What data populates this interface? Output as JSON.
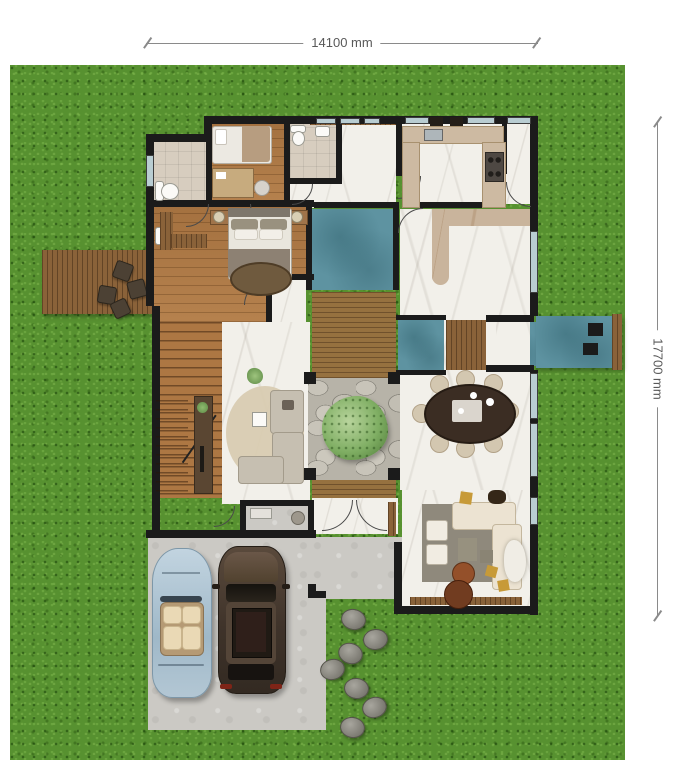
{
  "annotations": {
    "width_label": "14100 mm",
    "height_label": "17700 mm"
  },
  "palette": {
    "page_bg": "#ffffff",
    "grass": "#579130",
    "wall": "#1b1b1b",
    "marble": "#f2f0ea",
    "tile": "#d7cdbf",
    "wood_floor": "#ad7743",
    "deck_wood": "#8a6239",
    "walkway_wood": "#96713f",
    "water_teal": "#5e93a1",
    "stone": "#b7b3a8",
    "concrete": "#cbc9c4",
    "tree_green": "#7fae63",
    "window_glass": "#b9cdd2",
    "dim_line": "#8a8a8a",
    "dim_text": "#595959"
  },
  "scene": {
    "type": "residential-floor-plan-top-view",
    "rooms": [
      "bathroom",
      "small-bedroom",
      "second-bathroom",
      "entry-hall",
      "kitchen",
      "pantry",
      "master-bedroom",
      "staircase",
      "living-room",
      "courtyard-with-tree",
      "dining-room",
      "family-room",
      "wc",
      "vestibule"
    ],
    "exterior": [
      "lawn",
      "wood-deck",
      "driveway",
      "patio",
      "stepping-stones",
      "water-feature-walkway",
      "water-squares"
    ],
    "vehicles": [
      "convertible-car",
      "suv-car"
    ],
    "stepping_stones_count": 7,
    "dining_chairs_count": 8
  }
}
